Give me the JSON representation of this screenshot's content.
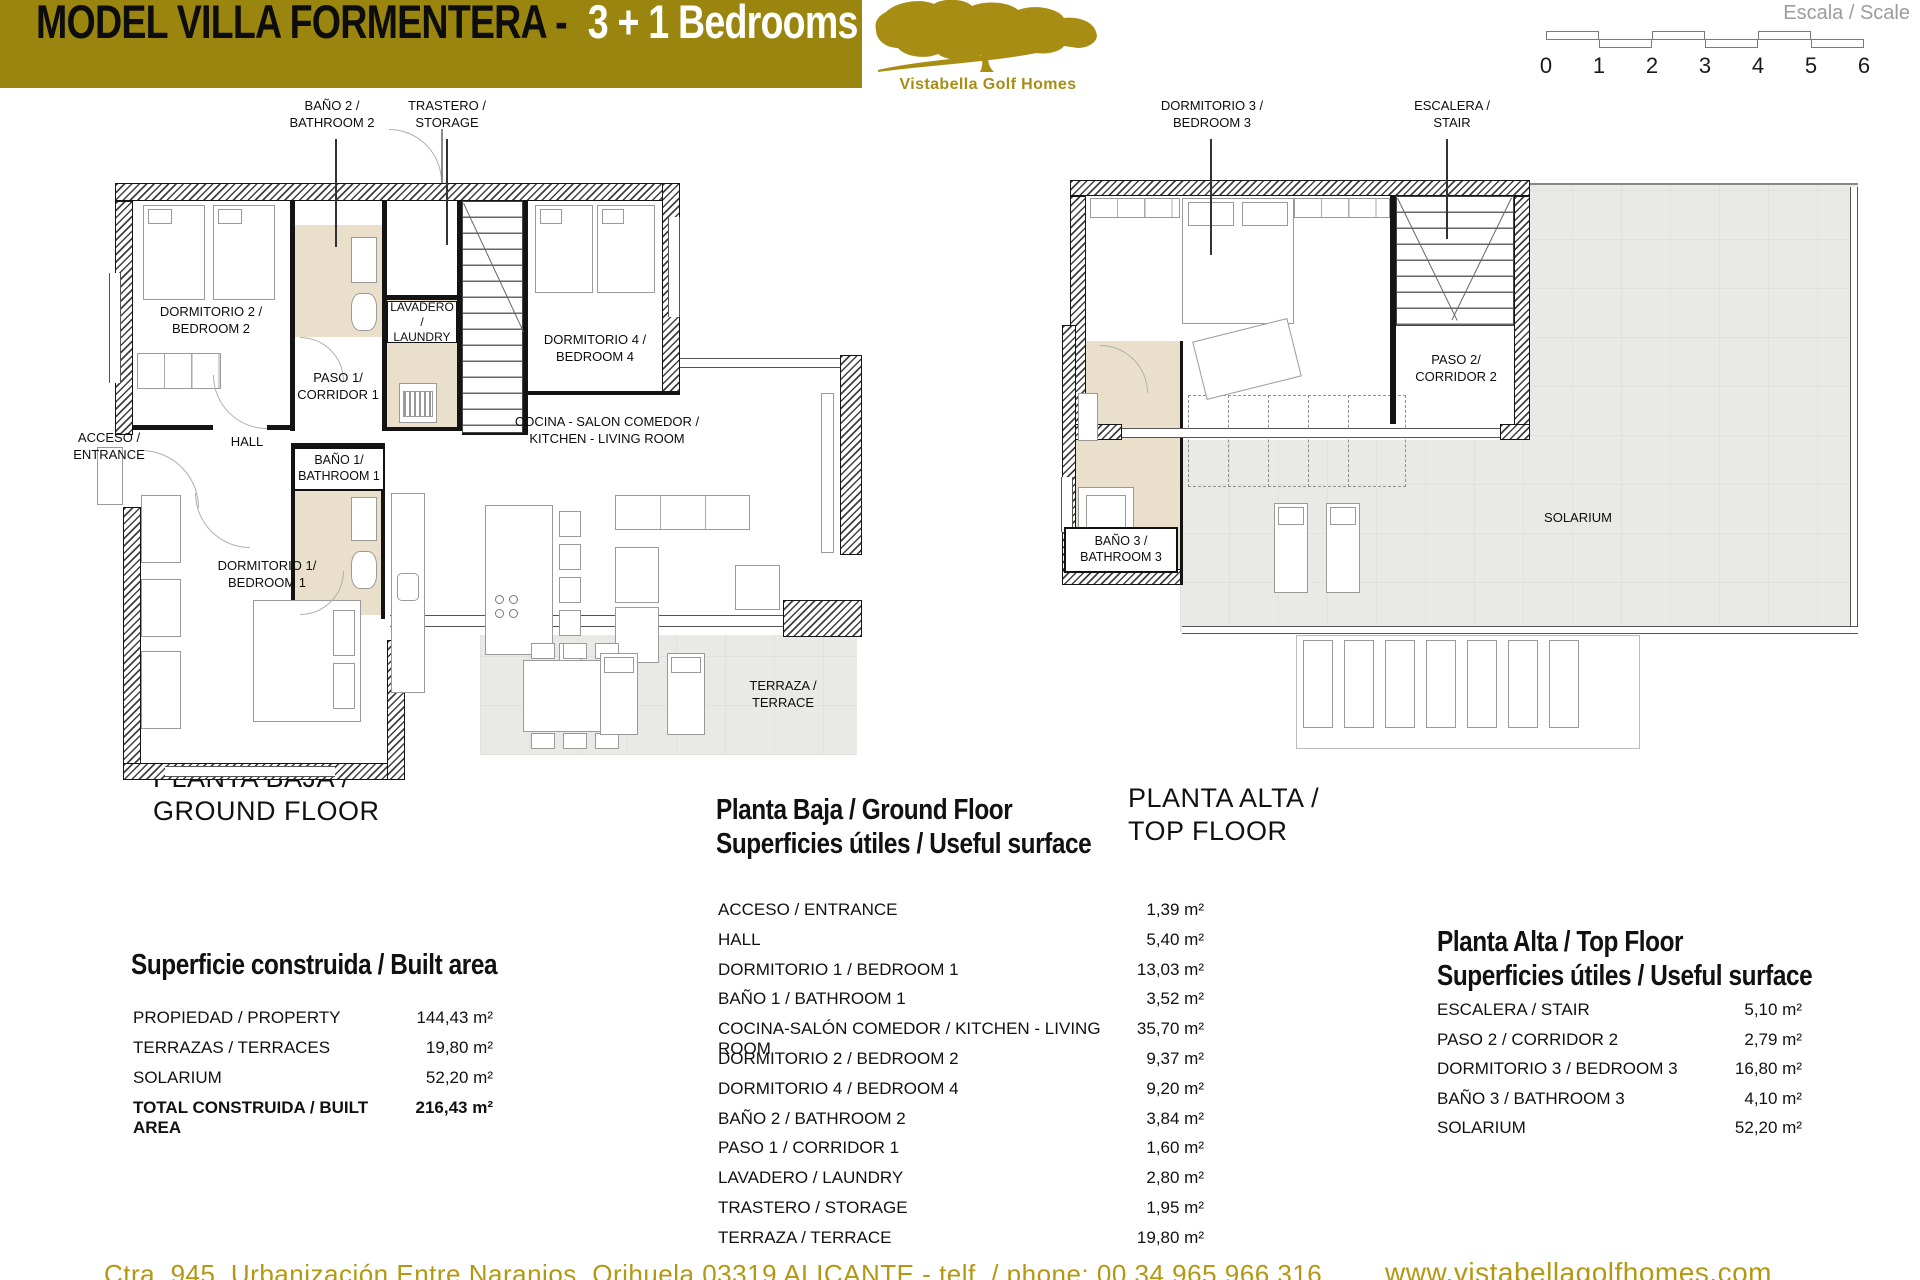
{
  "title": {
    "model": "MODEL VILLA  FORMENTERA - ",
    "bedrooms": "3 + 1 Bedrooms"
  },
  "logo": {
    "name": "Vistabella Golf Homes"
  },
  "scale": {
    "label": "Escala / Scale",
    "ticks": [
      "0",
      "1",
      "2",
      "3",
      "4",
      "5",
      "6"
    ]
  },
  "colors": {
    "brand_gold": "#9A850F",
    "logo_gold": "#A88D15",
    "footer_gold": "#B49712",
    "bath_floor_tan": "#EADFCB",
    "outdoor_gray": "#E9E9E6"
  },
  "ground_plan": {
    "heading": "PLANTA BAJA /\nGROUND FLOOR",
    "callouts": {
      "bathroom2": "BAÑO 2 /\nBATHROOM 2",
      "storage": "TRASTERO /\nSTORAGE"
    },
    "rooms": {
      "bedroom2": "DORMITORIO 2 /\nBEDROOM 2",
      "bedroom4": "DORMITORIO 4 /\nBEDROOM 4",
      "laundry": "LAVADERO /\nLAUNDRY",
      "corridor1": "PASO 1/\nCORRIDOR 1",
      "kitchen": "COCINA - SALON COMEDOR /\nKITCHEN - LIVING ROOM",
      "hall": "HALL",
      "entrance": "ACCESO /\nENTRANCE",
      "bathroom1": "BAÑO 1/\nBATHROOM 1",
      "bedroom1": "DORMITORIO 1/\nBEDROOM 1",
      "terrace": "TERRAZA /\nTERRACE"
    }
  },
  "top_plan": {
    "heading": "PLANTA ALTA /\nTOP FLOOR",
    "callouts": {
      "bedroom3": "DORMITORIO 3 /\nBEDROOM 3",
      "stair": "ESCALERA /\nSTAIR"
    },
    "rooms": {
      "corridor2": "PASO 2/\nCORRIDOR 2",
      "bathroom3": "BAÑO 3 /\nBATHROOM 3",
      "solarium": "SOLARIUM"
    }
  },
  "built_area": {
    "title": "Superficie construida / Built area",
    "rows": [
      {
        "label": "PROPIEDAD / PROPERTY",
        "value": "144,43 m²"
      },
      {
        "label": "TERRAZAS / TERRACES",
        "value": "19,80 m²"
      },
      {
        "label": "SOLARIUM",
        "value": "52,20 m²"
      },
      {
        "label": "TOTAL CONSTRUIDA / BUILT AREA",
        "value": "216,43 m²"
      }
    ]
  },
  "ground_table": {
    "title": "Planta Baja / Ground Floor\nSuperficies útiles / Useful surface",
    "rows": [
      {
        "label": "ACCESO / ENTRANCE",
        "value": "1,39 m²"
      },
      {
        "label": "HALL",
        "value": "5,40 m²"
      },
      {
        "label": "DORMITORIO 1 / BEDROOM 1",
        "value": "13,03 m²"
      },
      {
        "label": "BAÑO 1 / BATHROOM 1",
        "value": "3,52 m²"
      },
      {
        "label": "COCINA-SALÓN COMEDOR / KITCHEN - LIVING ROOM",
        "value": "35,70 m²"
      },
      {
        "label": "DORMITORIO 2 / BEDROOM 2",
        "value": "9,37 m²"
      },
      {
        "label": "DORMITORIO 4 / BEDROOM 4",
        "value": "9,20 m²"
      },
      {
        "label": "BAÑO 2 / BATHROOM 2",
        "value": "3,84 m²"
      },
      {
        "label": "PASO 1 / CORRIDOR 1",
        "value": "1,60 m²"
      },
      {
        "label": "LAVADERO / LAUNDRY",
        "value": "2,80 m²"
      },
      {
        "label": "TRASTERO / STORAGE",
        "value": "1,95 m²"
      },
      {
        "label": "TERRAZA / TERRACE",
        "value": "19,80 m²"
      }
    ]
  },
  "top_table": {
    "title": "Planta Alta / Top Floor\nSuperficies útiles / Useful surface",
    "rows": [
      {
        "label": "ESCALERA / STAIR",
        "value": "5,10 m²"
      },
      {
        "label": "PASO 2 / CORRIDOR 2",
        "value": "2,79 m²"
      },
      {
        "label": "DORMITORIO 3 / BEDROOM 3",
        "value": "16,80 m²"
      },
      {
        "label": "BAÑO 3 / BATHROOM 3",
        "value": "4,10 m²"
      },
      {
        "label": "SOLARIUM",
        "value": "52,20 m²"
      }
    ]
  },
  "footer": {
    "address": "Ctra. 945, Urbanización Entre Naranjos, Orihuela 03319 ALICANTE - telf. / phone: 00 34 965 966 316",
    "website": "www.vistabellagolfhomes.com"
  }
}
